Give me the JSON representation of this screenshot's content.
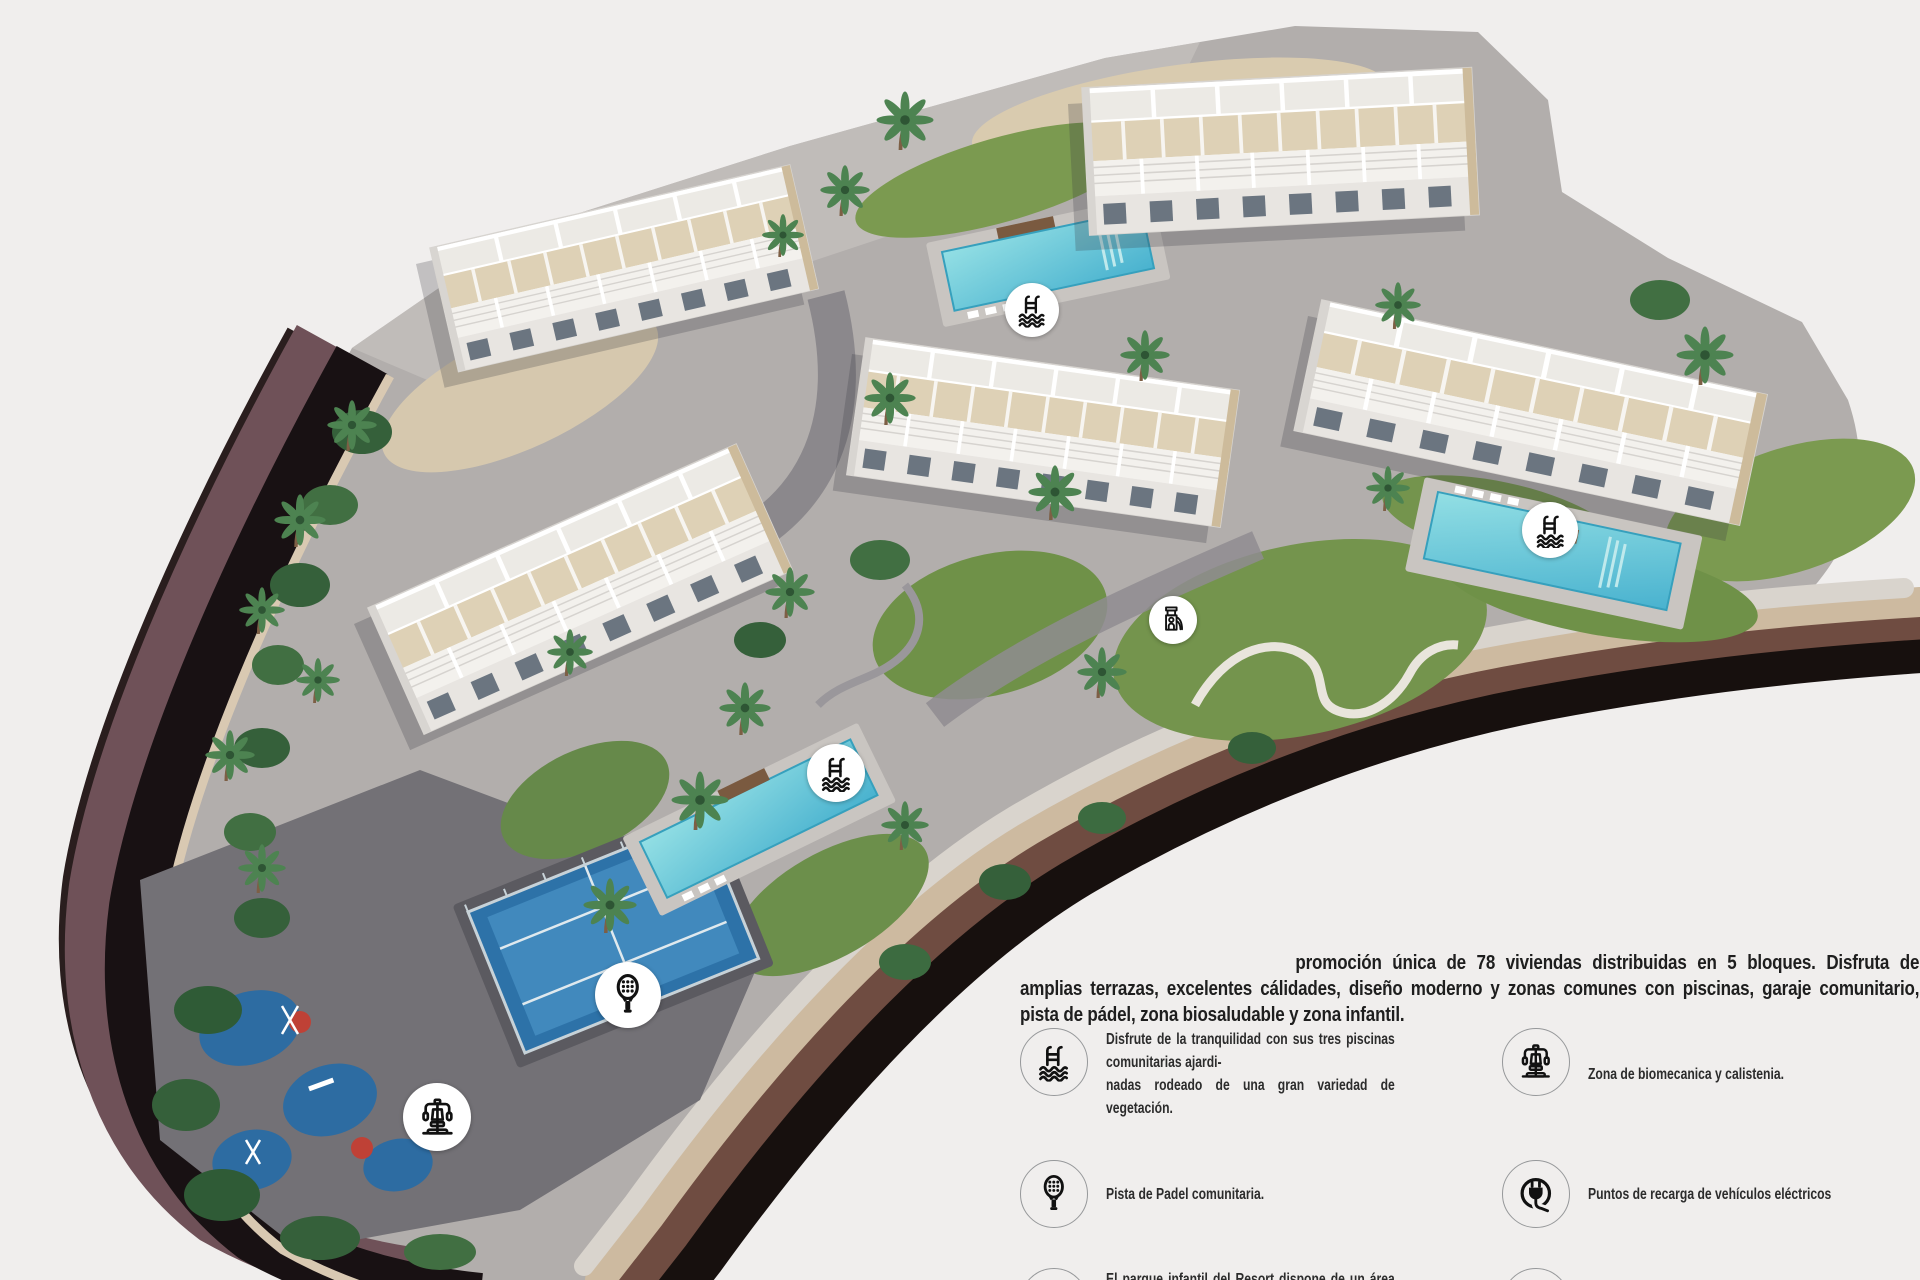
{
  "intro": {
    "text": "promoción única de 78 viviendas distribuidas en 5 bloques. Disfruta de amplias terrazas, excelentes cálidades, diseño moderno y zonas comunes con piscinas, garaje comunitario, pista de pádel, zona biosaludable y zona infantil."
  },
  "legend": {
    "items": [
      {
        "icon": "pool-icon",
        "text": "Disfrute de la tranquilidad con sus tres piscinas comunitarias ajardi-\nnadas rodeado de una gran variedad de vegetación."
      },
      {
        "icon": "biomechanics-icon",
        "text": "Zona de biomecanica y calistenia."
      },
      {
        "icon": "padel-icon",
        "text": "Pista de Padel comunitaria."
      },
      {
        "icon": "ev-charger-icon",
        "text": "Puntos de recarga de vehículos eléctricos"
      },
      {
        "icon": "playground-icon",
        "text": "El parque infantil del Resort dispone de un área de juegos\npara los mas pequeños."
      },
      {
        "icon": "cctv-icon",
        "text": "Seguridad y CCTV"
      }
    ]
  },
  "map_markers": [
    {
      "icon": "pool-icon",
      "x": 1032,
      "y": 310,
      "d": 54
    },
    {
      "icon": "pool-icon",
      "x": 1550,
      "y": 530,
      "d": 56
    },
    {
      "icon": "pool-icon",
      "x": 836,
      "y": 773,
      "d": 58
    },
    {
      "icon": "padel-icon",
      "x": 628,
      "y": 995,
      "d": 66
    },
    {
      "icon": "biomechanics-icon",
      "x": 437,
      "y": 1117,
      "d": 68
    },
    {
      "icon": "playground-icon",
      "x": 1173,
      "y": 620,
      "d": 48
    }
  ],
  "colors": {
    "background": "#f0eeed",
    "water": "#5fc3d6",
    "road": "#6f5158",
    "lawn": "#74944d",
    "icon_glyph": "#111111",
    "icon_circle_bg": "#ffffff",
    "text": "#1e1e1e"
  }
}
